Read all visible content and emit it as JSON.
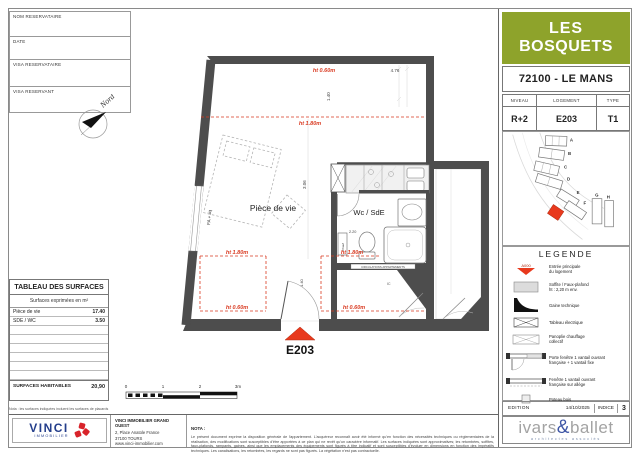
{
  "reservation_form": {
    "fields": [
      "NOM RESERVATAIRE",
      "DATE",
      "VISA RESERVATAIRE",
      "VISA RESERVANT"
    ]
  },
  "compass": {
    "label": "Nord"
  },
  "surface_table": {
    "title": "TABLEAU DES SURFACES",
    "subtitle": "Surfaces exprimées en m²",
    "rows": [
      {
        "label": "Pièce de vie",
        "value": "17.40"
      },
      {
        "label": "SDE / WC",
        "value": "3.50"
      }
    ],
    "total_label": "SURFACES HABITABLES",
    "total_value": "20,90"
  },
  "plan": {
    "living_label": "Pièce de vie",
    "wc_label": "Wc / SdE",
    "entrance_label": "E203",
    "window_label": "FA + liq",
    "chauf_label": "Chauf",
    "ic_label": "IC",
    "wall_note": "CIRCULATIONS APPARTEMENTS",
    "ht_top": "ht 0.60m",
    "ht_upper": "ht 1.80m",
    "ht_left_mid": "ht 1.80m",
    "ht_left_low": "ht 0.60m",
    "ht_wc_mid": "ht 1.80m",
    "ht_wc_low": "ht 0.60m",
    "dim_width": "4.76",
    "dim_top": "1.40",
    "dim_living": "3.06",
    "dim_wc": "2.20",
    "dim_door": "1.40",
    "scale_ticks": [
      "0",
      "1",
      "2",
      "3m"
    ]
  },
  "title_block": {
    "project_line1": "LES",
    "project_line2": "BOSQUETS",
    "city": "72100 - LE MANS",
    "info": {
      "niveau_label": "NIVEAU",
      "niveau": "R+2",
      "logement_label": "LOGEMENT",
      "logement": "E203",
      "type_label": "TYPE",
      "type": "T1"
    },
    "site_buildings": [
      "A",
      "B",
      "C",
      "D",
      "E",
      "F",
      "G",
      "H"
    ],
    "legend": {
      "title": "LEGENDE",
      "entry_tag": "A000",
      "items": [
        {
          "label": "Entrée principale\ndu logement"
        },
        {
          "label": "Soffite / Faux-plafond\nht : 2,20 m env."
        },
        {
          "label": "Gaine technique"
        },
        {
          "label": "Tableau électrique"
        },
        {
          "label": "Panoplie chauffage\ncollectif"
        },
        {
          "label": "Porte fenêtre 1 vantail ouvrant\nfrançaise + 1 vantail fixe"
        },
        {
          "label": "Fenêtre 1 vantail ouvrant\nfrançaise sur allège"
        },
        {
          "label": "Poteau bois"
        }
      ]
    },
    "edition": {
      "label": "EDITION",
      "date": "14/10/2025",
      "indice_label": "INDICE",
      "indice": "3"
    },
    "architect": {
      "left": "ivars",
      "amp": "&",
      "right": "ballet",
      "tagline": "architectes associés"
    }
  },
  "footer": {
    "nota_small": "Nota : les surfaces indiquées incluent les surfaces de placards",
    "vinci": {
      "brand": "VINCI",
      "division": "IMMOBILIER",
      "office": "VINCI IMMOBILIER GRAND OUEST",
      "address1": "2, Place Anatole France",
      "address2": "37100 TOURS",
      "website": "www.vinci-immobilier.com"
    },
    "nota_title": "NOTA :",
    "nota_text": "Le présent document exprime la disposition générale de l'appartement. L'acquéreur reconnaît avoir été informé qu'en fonction des nécessités techniques ou réglementaires de la réalisation, des modifications sont susceptibles d'être apportées à ce plan qui ne revêt qu'un caractère informatif. Les surfaces indiquées sont approximatives; les retombées, soffites, faux-plafonds, rampants, gaines, ainsi que les emplacements des équipements sont figurés à titre indicatif et sont susceptibles d'évoluer en dimensions en fonction des impératifs techniques. Les canalisations, les retombées, les regards ne sont pas figurés. La végétation n'est pas contractuelle."
  }
}
